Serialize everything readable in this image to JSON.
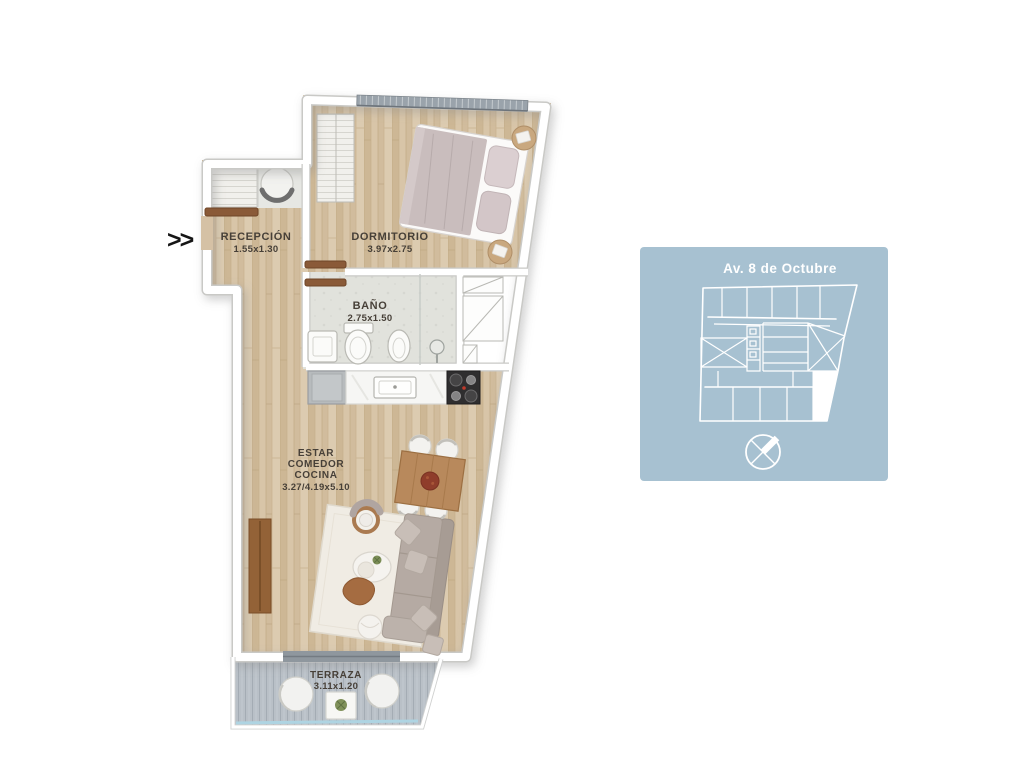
{
  "background": "#ffffff",
  "floorplan": {
    "entrance_marker": ">>",
    "rooms": {
      "recepcion": {
        "name": "RECEPCIÓN",
        "dims": "1.55x1.30"
      },
      "dormitorio": {
        "name": "DORMITORIO",
        "dims": "3.97x2.75"
      },
      "bano": {
        "name": "BAÑO",
        "dims": "2.75x1.50"
      },
      "estar": {
        "name_line1": "ESTAR",
        "name_line2": "COMEDOR",
        "name_line3": "COCINA",
        "dims": "3.27/4.19x5.10"
      },
      "terraza": {
        "name": "TERRAZA",
        "dims": "3.11x1.20"
      }
    },
    "colors": {
      "wood_floor": "#d5c1a5",
      "bath_tile": "#e1e2dc",
      "terrace_deck": "#b9c0c7",
      "door_wood": "#8a5a38",
      "glass_railing": "#aed4e2",
      "label_text": "#474038"
    }
  },
  "key_plan": {
    "street_label": "Av. 8 de Octubre",
    "panel_color": "#a7c1d1",
    "line_color": "#ffffff",
    "highlighted_unit_color": "#ffffff"
  }
}
